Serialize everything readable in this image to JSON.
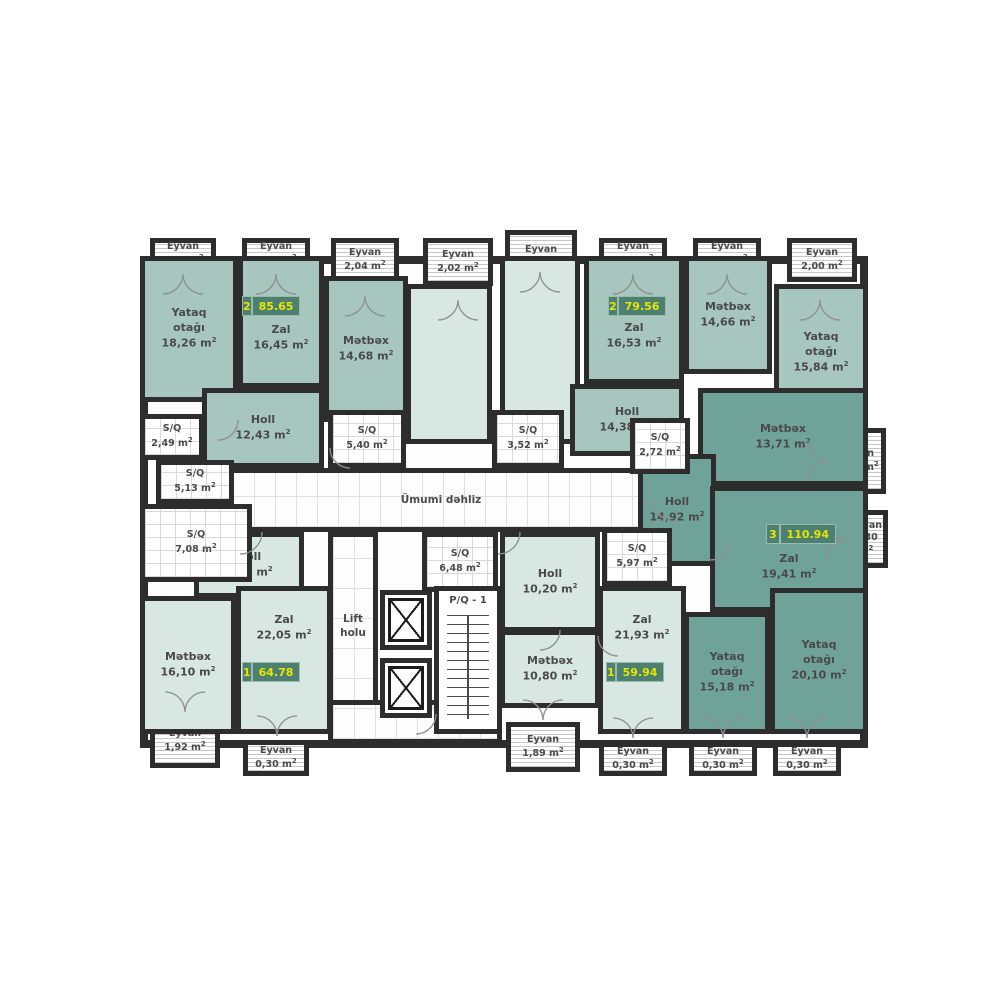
{
  "floor_plan": {
    "language": "az",
    "unit_suffix": "m²",
    "colors": {
      "wall": "#2d2d2d",
      "apartment_light": "#d9e7e2",
      "apartment_medium": "#a6c6be",
      "apartment_dark": "#6fa299",
      "badge_background": "#4d8071",
      "badge_text": "#e6e600",
      "room_text": "#4a4a4a"
    },
    "apartment_badges": [
      {
        "id": "apt-85",
        "rooms_count": "2",
        "total_area": "85.65"
      },
      {
        "id": "apt-79",
        "rooms_count": "2",
        "total_area": "79.56"
      },
      {
        "id": "apt-110",
        "rooms_count": "3",
        "total_area": "110.94"
      },
      {
        "id": "apt-64",
        "rooms_count": "1",
        "total_area": "64.78"
      },
      {
        "id": "apt-59",
        "rooms_count": "1",
        "total_area": "59.94"
      }
    ],
    "rooms": [
      {
        "id": "umumi",
        "label": "Ümumi dəhliz",
        "area": "",
        "fill": "corridor"
      },
      {
        "id": "lift-holu",
        "label": "Lift\nholu",
        "area": "",
        "fill": "corridor"
      },
      {
        "id": "lobby-bot",
        "label": "",
        "area": "",
        "fill": "corridor"
      },
      {
        "id": "room-m1",
        "label": "",
        "area": "",
        "fill": "light"
      },
      {
        "id": "room-m2",
        "label": "",
        "area": "",
        "fill": "light"
      },
      {
        "id": "holl-bl",
        "label": "Holl",
        "area": "8,48",
        "fill": "light"
      },
      {
        "id": "metbex-bl",
        "label": "Mətbəx",
        "area": "16,10",
        "fill": "light"
      },
      {
        "id": "zal-bl",
        "label": "Zal",
        "area": "22,05",
        "fill": "light"
      },
      {
        "id": "holl-br",
        "label": "Holl",
        "area": "10,20",
        "fill": "light"
      },
      {
        "id": "metbex-bm",
        "label": "Mətbəx",
        "area": "10,80",
        "fill": "light"
      },
      {
        "id": "zal-br",
        "label": "Zal",
        "area": "21,93",
        "fill": "light"
      },
      {
        "id": "yataq-tl",
        "label": "Yataq\notağı",
        "area": "18,26",
        "fill": "medium"
      },
      {
        "id": "zal-tl",
        "label": "Zal",
        "area": "16,45",
        "fill": "medium"
      },
      {
        "id": "metbex-tl",
        "label": "Mətbəx",
        "area": "14,68",
        "fill": "medium"
      },
      {
        "id": "holl-tl",
        "label": "Holl",
        "area": "12,43",
        "fill": "medium"
      },
      {
        "id": "zal-tr",
        "label": "Zal",
        "area": "16,53",
        "fill": "medium"
      },
      {
        "id": "metbex-tr",
        "label": "Mətbəx",
        "area": "14,66",
        "fill": "medium"
      },
      {
        "id": "yataq-tr",
        "label": "Yataq\notağı",
        "area": "15,84",
        "fill": "medium"
      },
      {
        "id": "holl-tr",
        "label": "Holl",
        "area": "14,38",
        "fill": "medium"
      },
      {
        "id": "metbex-r",
        "label": "Mətbəx",
        "area": "13,71",
        "fill": "dark"
      },
      {
        "id": "holl-r",
        "label": "Holl",
        "area": "14,92",
        "fill": "dark"
      },
      {
        "id": "zal-r",
        "label": "Zal",
        "area": "19,41",
        "fill": "dark"
      },
      {
        "id": "yataq-br1",
        "label": "Yataq\notağı",
        "area": "15,18",
        "fill": "dark"
      },
      {
        "id": "yataq-br2",
        "label": "Yataq\notağı",
        "area": "20,10",
        "fill": "dark"
      },
      {
        "id": "sq-249",
        "label": "S/Q",
        "area": "2,49",
        "fill": "wet"
      },
      {
        "id": "sq-513",
        "label": "S/Q",
        "area": "5,13",
        "fill": "wet"
      },
      {
        "id": "sq-708",
        "label": "S/Q",
        "area": "7,08",
        "fill": "wet"
      },
      {
        "id": "sq-540",
        "label": "S/Q",
        "area": "5,40",
        "fill": "wet"
      },
      {
        "id": "sq-352",
        "label": "S/Q",
        "area": "3,52",
        "fill": "wet"
      },
      {
        "id": "sq-272",
        "label": "S/Q",
        "area": "2,72",
        "fill": "wet"
      },
      {
        "id": "sq-648",
        "label": "S/Q",
        "area": "6,48",
        "fill": "wet"
      },
      {
        "id": "sq-597",
        "label": "S/Q",
        "area": "5,97",
        "fill": "wet"
      },
      {
        "id": "stairs",
        "label": "P/Q - 1",
        "area": "",
        "fill": "stairs"
      },
      {
        "id": "lift1",
        "label": "",
        "area": "",
        "fill": "lift"
      },
      {
        "id": "lift2",
        "label": "",
        "area": "",
        "fill": "lift"
      }
    ],
    "balconies": [
      {
        "id": "b1",
        "label": "Eyvan",
        "area": "0,30"
      },
      {
        "id": "b2",
        "label": "Eyvan",
        "area": "0,30"
      },
      {
        "id": "b3",
        "label": "Eyvan",
        "area": "2,04"
      },
      {
        "id": "b4",
        "label": "Eyvan",
        "area": "2,02"
      },
      {
        "id": "b5",
        "label": "Eyvan",
        "area": ""
      },
      {
        "id": "b6",
        "label": "Eyvan",
        "area": "0,30"
      },
      {
        "id": "b7",
        "label": "Eyvan",
        "area": "0,30"
      },
      {
        "id": "b8",
        "label": "Eyvan",
        "area": "2,00"
      },
      {
        "id": "b9",
        "label": "Eyvan",
        "area": "1,97"
      },
      {
        "id": "b10",
        "label": "Eyvan",
        "area": "0,30"
      },
      {
        "id": "b11",
        "label": "Eyvan",
        "area": "1,92"
      },
      {
        "id": "b12",
        "label": "Eyvan",
        "area": "0,30"
      },
      {
        "id": "b13",
        "label": "Eyvan",
        "area": "1,89"
      },
      {
        "id": "b14",
        "label": "Eyvan",
        "area": "0,30"
      },
      {
        "id": "b15",
        "label": "Eyvan",
        "area": "0,30"
      },
      {
        "id": "b16",
        "label": "Eyvan",
        "area": "0,30"
      }
    ]
  }
}
